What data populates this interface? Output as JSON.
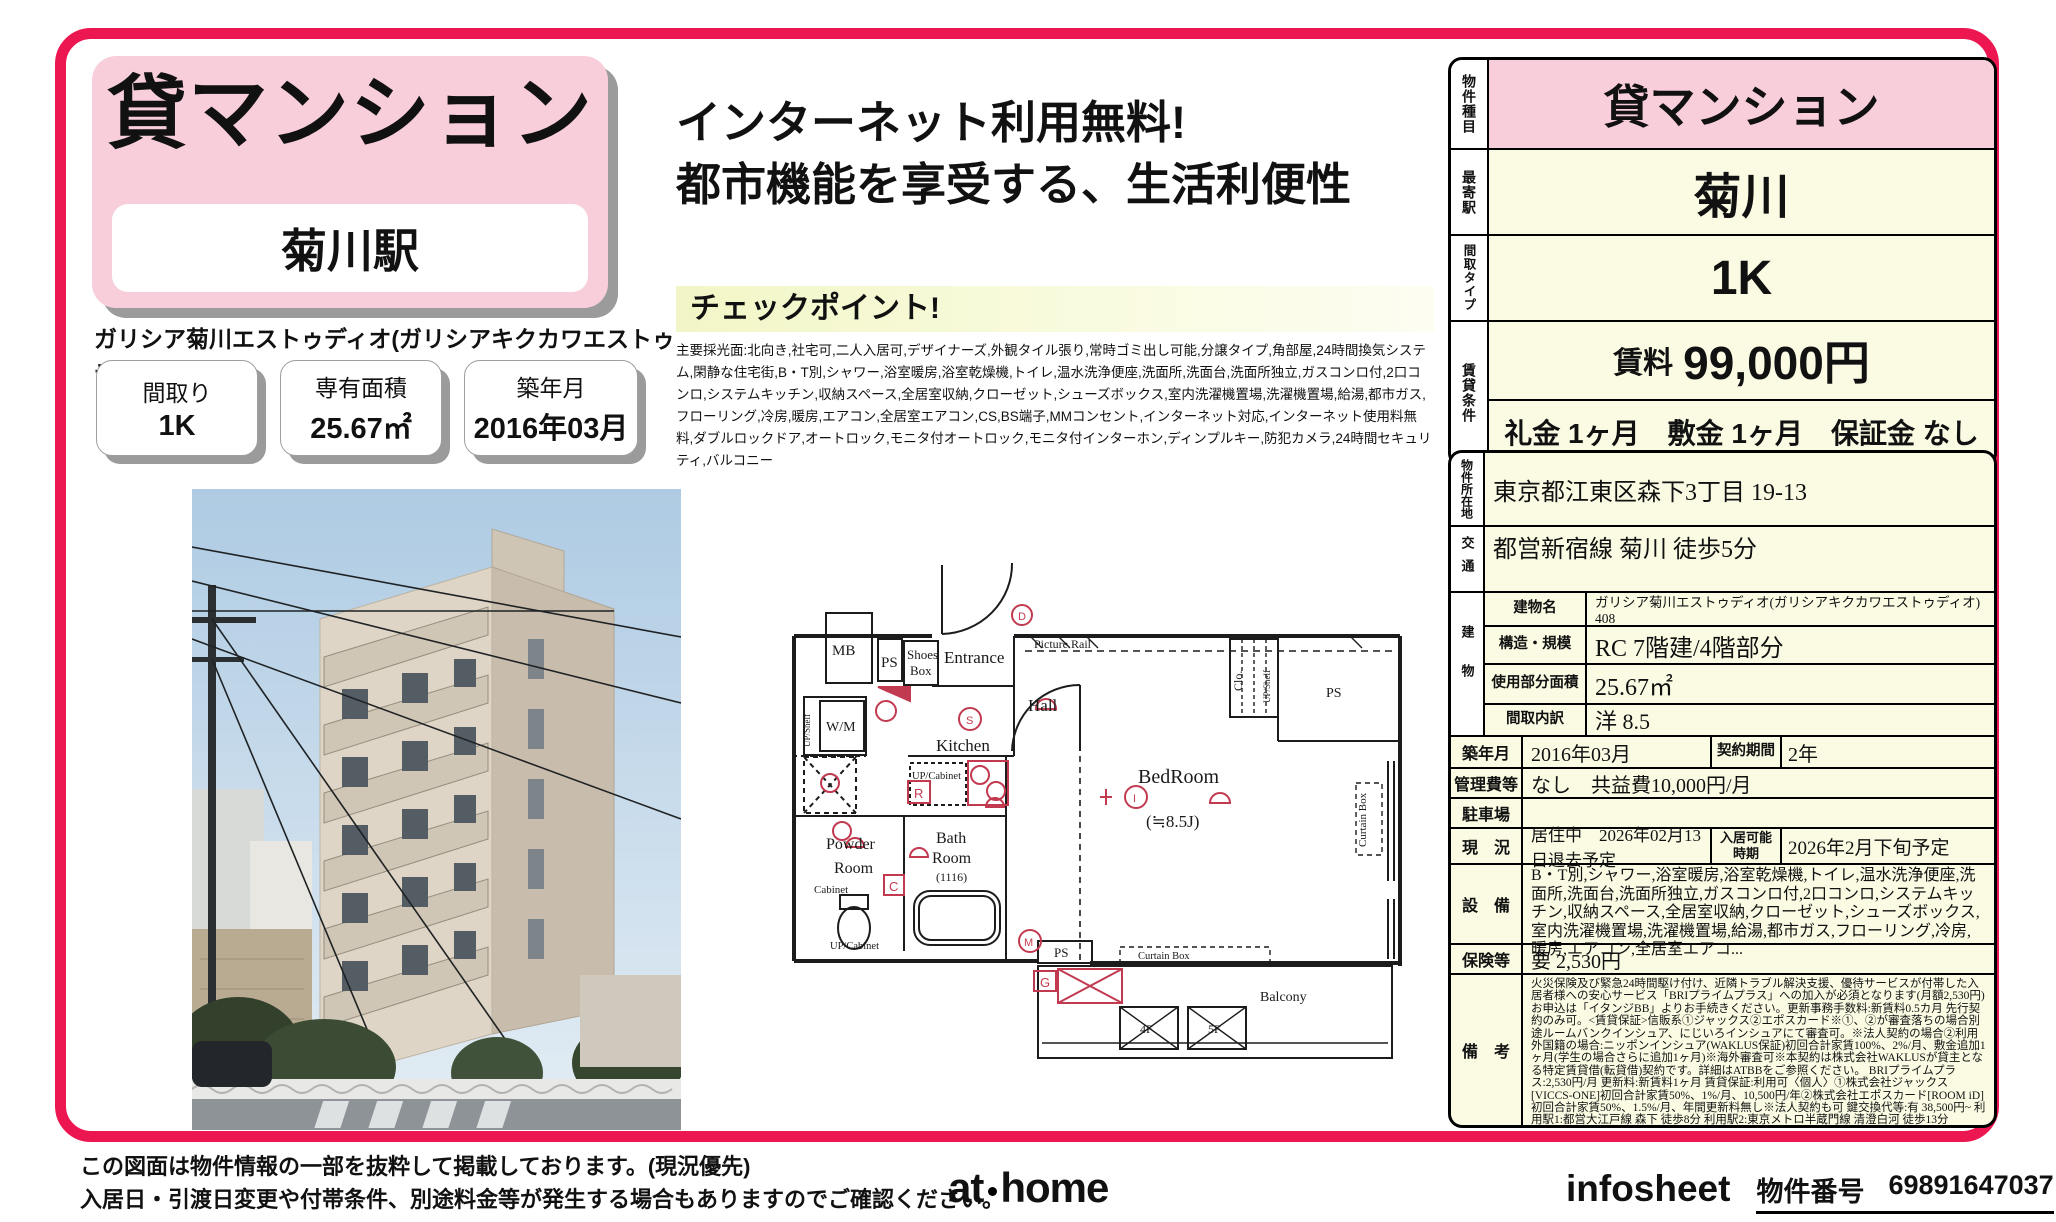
{
  "colors": {
    "frame_pink": "#EC1651",
    "panel_pink": "#F9CEDB",
    "table_cream": "#FBFBE4",
    "checkpoint_yellow": "#F2F6C6",
    "plan_red": "#C23A50"
  },
  "header": {
    "property_type": "貸マンション",
    "station": "菊川駅",
    "property_name": "ガリシア菊川エストゥディオ(ガリシアキクカワエストゥディオ)　408",
    "badges": [
      {
        "label": "間取り",
        "value": "1K"
      },
      {
        "label": "専有面積",
        "value": "25.67㎡"
      },
      {
        "label": "築年月",
        "value": "2016年03月"
      }
    ]
  },
  "headline": {
    "line1": "インターネット利用無料!",
    "line2": "都市機能を享受する、生活利便性"
  },
  "checkpoint": {
    "title": "チェックポイント!",
    "body": "主要採光面:北向き,社宅可,二人入居可,デザイナーズ,外観タイル張り,常時ゴミ出し可能,分譲タイプ,角部屋,24時間換気システム,閑静な住宅街,B・T別,シャワー,浴室暖房,浴室乾燥機,トイレ,温水洗浄便座,洗面所,洗面台,洗面所独立,ガスコンロ付,2口コンロ,システムキッチン,収納スペース,全居室収納,クローゼット,シューズボックス,室内洗濯機置場,洗濯機置場,給湯,都市ガス,フローリング,冷房,暖房,エアコン,全居室エアコン,CS,BS端子,MMコンセント,インターネット対応,インターネット使用料無料,ダブルロックドア,オートロック,モニタ付オートロック,モニタ付インターホン,ディンプルキー,防犯カメラ,24時間セキュリティ,バルコニー"
  },
  "floorplan": {
    "mb": "MB",
    "ps": "PS",
    "shoes1": "Shoes",
    "shoes2": "Box",
    "entrance": "Entrance",
    "hall": "Hall",
    "s_mark": "S",
    "kitchen": "Kitchen",
    "up_cabinet": "UP/Cabinet",
    "wm": "W/M",
    "up_shelf": "UP/Shelf",
    "powder1": "Powder",
    "powder2": "Room",
    "cabinet": "Cabinet",
    "up_cabinet2": "UP/Cabinet",
    "bath1": "Bath",
    "bath2": "Room",
    "bath3": "(1116)",
    "bedroom": "BedRoom",
    "bedroom_size": "(≒8.5J)",
    "picture_rail": "Picture Rail",
    "clo": "Clo.",
    "up_shelf2": "UP/Shelf",
    "ps2": "PS",
    "curtain_box_v": "Curtain Box",
    "curtain_box_h": "Curtain Box",
    "ps3": "PS",
    "balcony": "Balcony",
    "f4": "4F",
    "f5": "5F",
    "r_mark": "R",
    "c_mark": "C",
    "g_mark": "G",
    "m_mark": "M",
    "i_mark": "I",
    "d_mark": "D"
  },
  "side": {
    "t1": {
      "type_label": "物件種目",
      "type_value": "貸マンション",
      "station_label": "最寄駅",
      "station_value": "菊川",
      "layout_label": "間取タイプ",
      "layout_value": "1K",
      "terms_label": "賃貸条件",
      "rent_label": "賃料",
      "rent_value": "99,000円",
      "terms_detail": "礼金 1ヶ月　敷金 1ヶ月　保証金 なし"
    },
    "t2": {
      "address_label": "物件所在地",
      "address": "東京都江東区森下3丁目 19-13",
      "access_label": "交通",
      "access": "都営新宿線 菊川 徒歩5分",
      "building_label": "建物",
      "building_name_label": "建物名",
      "building_name": "ガリシア菊川エストゥディオ(ガリシアキクカワエストゥディオ)　408",
      "structure_label": "構造・規模",
      "structure": "RC 7階建/4階部分",
      "area_label": "使用部分面積",
      "area": "25.67㎡",
      "layout_detail_label": "間取内訳",
      "layout_detail": "洋 8.5",
      "built_label": "築年月",
      "built": "2016年03月",
      "contract_label": "契約期間",
      "contract": "2年",
      "mgmt_label": "管理費等",
      "mgmt": "なし　共益費10,000円/月",
      "parking_label": "駐車場",
      "parking": "",
      "status_label": "現　況",
      "status": "居住中　2026年02月13日退去予定",
      "movein_label": "入居可能 時期",
      "movein": "2026年2月下旬予定",
      "equip_label": "設　備",
      "equipment": "B・T別,シャワー,浴室暖房,浴室乾燥機,トイレ,温水洗浄便座,洗面所,洗面台,洗面所独立,ガスコンロ付,2口コンロ,システムキッチン,収納スペース,全居室収納,クローゼット,シューズボックス,室内洗濯機置場,洗濯機置場,給湯,都市ガス,フローリング,冷房,暖房,エアコン,全居室エアコ...",
      "insurance_label": "保険等",
      "insurance": "要 2,530円",
      "notes_label": "備　考",
      "notes": "火災保険及び緊急24時間駆け付け、近隣トラブル解決支援、優待サービスが付帯した入居者様への安心サービス「BRIプライムプラス」への加入が必須となります(月額2,530円)お申込は「イタンジBB」よりお手続きください。更新事務手数料:新賃料0.5カ月 先行契約のみ可。<賃貸保証>信販系①ジャックス②エポスカード※①、②が審査落ちの場合別途ルームバンクインシュア、にじいろインシュアにて審査可。※法人契約の場合②利用 外国籍の場合:ニッポンインシュア(WAKLUS保証)初回合計家賃100%、2%/月、敷金追加1ヶ月(学生の場合さらに追加1ヶ月)※海外審査可※本契約は株式会社WAKLUSが貸主となる特定賃貸借(転貸借)契約です。詳細はATBBをご参照ください。 BRIプライムプラス:2,530円/月 更新料:新賃料1ヶ月 賃貸保証:利用可〈個人〉①株式会社ジャックス[VICCS-ONE]初回合計家賃50%、1%/月、10,500円/年②株式会社エポスカード[ROOM iD]初回合計家賃50%、1.5%/月、年間更新料無し※法人契約も可 鍵交換代等:有 38,500円~ 利用駅1:都営大江戸線 森下 徒歩8分 利用駅2:東京メトロ半蔵門線 清澄白河 徒歩13分"
    }
  },
  "footer": {
    "notice1": "この図面は物件情報の一部を抜粋して掲載しております。(現況優先)",
    "notice2": "入居日・引渡日変更や付帯条件、別途料金等が発生する場合もありますのでご確認ください。",
    "logo_at": "at",
    "logo_home": "home",
    "infosheet": "infosheet",
    "property_no_label": "物件番号",
    "property_no": "69891647037"
  }
}
